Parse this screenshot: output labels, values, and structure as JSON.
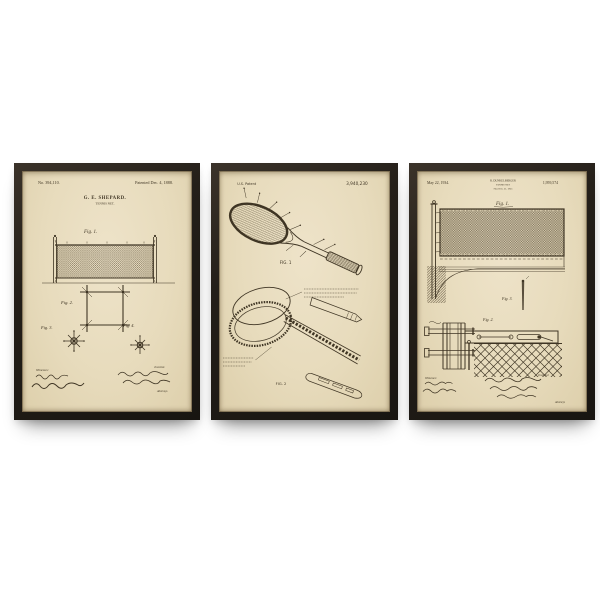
{
  "colors": {
    "background": "#ffffff",
    "frame": "#241f19",
    "paper": "#e7dbbc",
    "ink": "#3f3524"
  },
  "frames": [
    {
      "id": "tennis-net-1888-print",
      "header_left": "No. 394,110.",
      "header_right": "Patented Dec. 4, 1888.",
      "inventor_name": "G. E. SHEPARD.",
      "title": "TENNIS NET.",
      "fig1_label": "Fig. 1.",
      "fig2_label": "Fig. 2.",
      "fig3_label": "Fig. 3.",
      "fig4_label": "Fig. 4.",
      "witnesses_label": "Witnesses:",
      "inventor_label": "Inventor.",
      "attorneys_label": "Attorneys."
    },
    {
      "id": "tennis-racket-print",
      "header_left": "U.S. Patent",
      "header_right": "3,940,230",
      "fig1_label": "FIG. 1",
      "fig2_label": "FIG. 2"
    },
    {
      "id": "tennis-net-1934-print",
      "header_left": "May 22, 1934.",
      "inventor_name": "R. DUNKELBERGER",
      "title": "TENNIS NET",
      "filed_line": "Filed Feb. 21, 1933",
      "header_right": "1,959,574",
      "fig1_label": "Fig. 1.",
      "fig2_label": "Fig. 2.",
      "fig3_label": "Fig. 3.",
      "witnesses_label": "Witnesses:",
      "inventor_label": "Inventor",
      "attorneys_label": "Attorneys"
    }
  ]
}
